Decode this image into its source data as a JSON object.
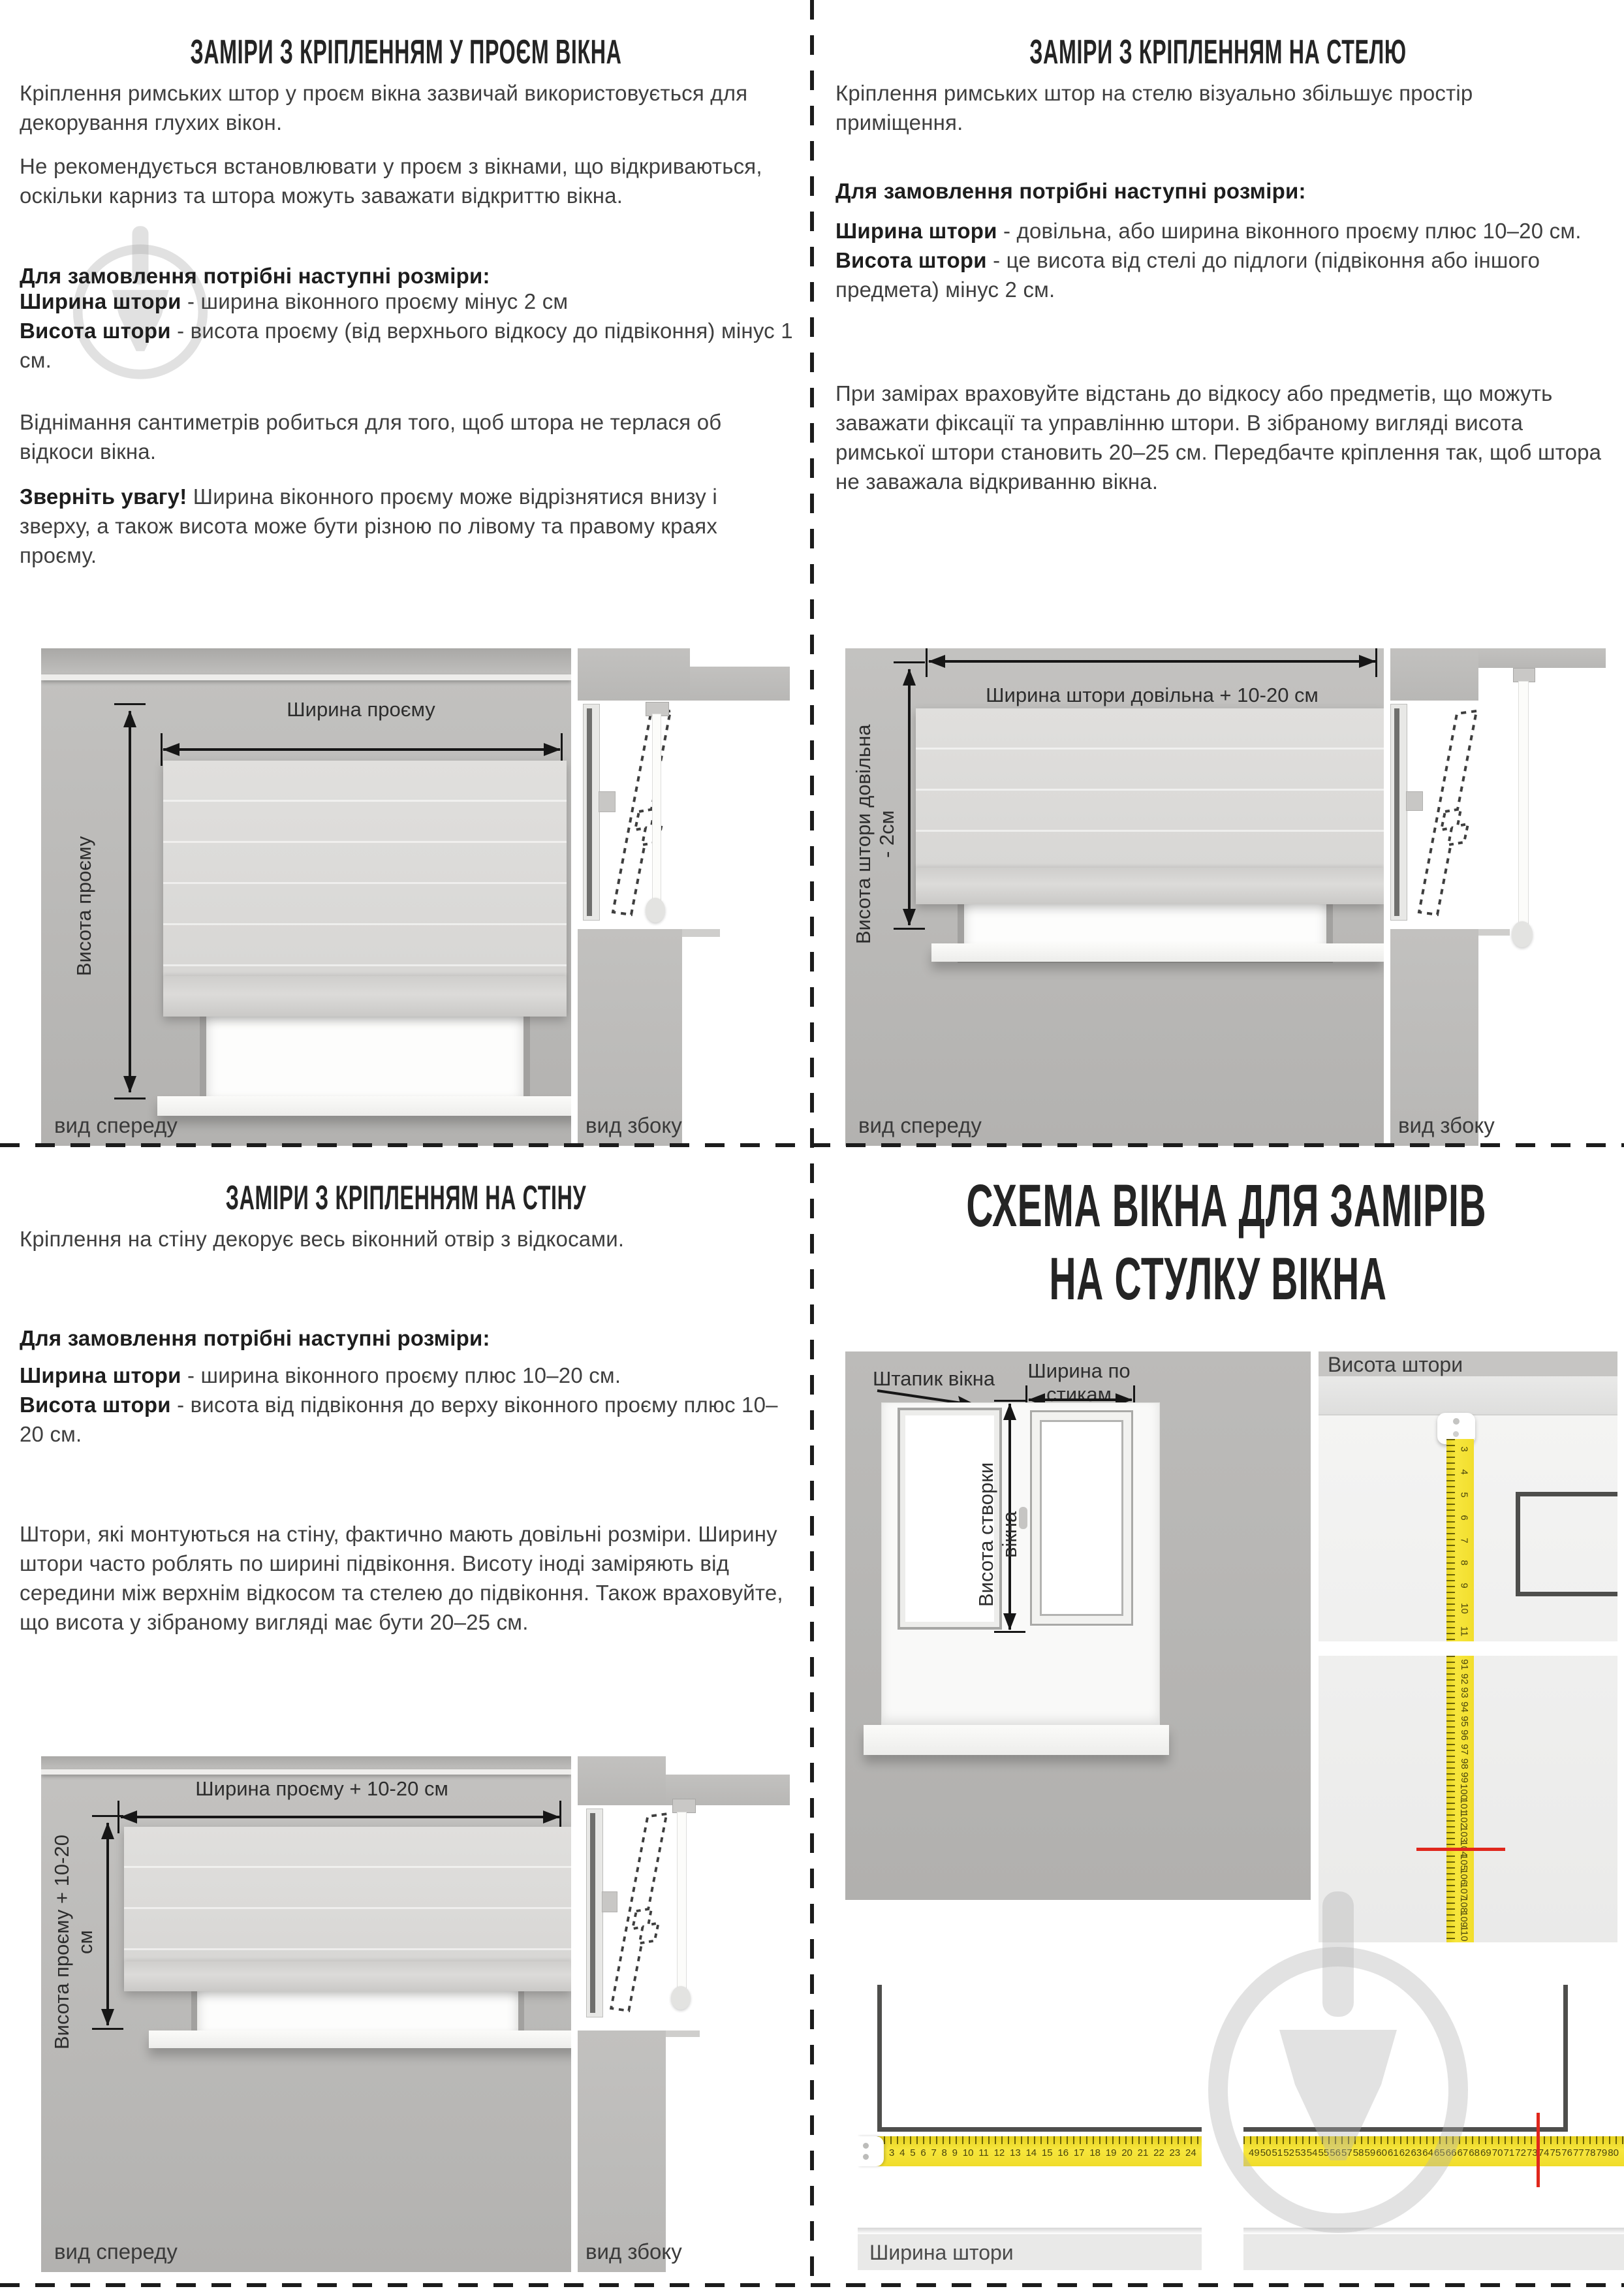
{
  "q1": {
    "title": "ЗАМІРИ З КРІПЛЕННЯМ У ПРОЄМ ВІКНА",
    "p1": "Кріплення римських штор у проєм вікна зазвичай використовується для декорування глухих вікон.",
    "p2": "Не рекомендується встановлювати у проєм з вікнами, що відкриваються, оскільки карниз та штора можуть заважати відкриттю вікна.",
    "lead": "Для замовлення потрібні наступні розміри:",
    "width_term": "Ширина штори",
    "width_def": " - ширина віконного проєму мінус 2 см",
    "height_term": "Висота штори",
    "height_def": " - висота проєму (від верхнього відкосу до підвіконня) мінус 1 см.",
    "p3": "Віднімання сантиметрів робиться для того, щоб штора не терлася об відкоси вікна.",
    "note_term": "Зверніть увагу!",
    "note_def": " Ширина віконного проєму може відрізнятися внизу і зверху, а також висота може бути різною по лівому та правому краях проєму.",
    "diagram": {
      "width_label": "Ширина проєму",
      "height_label": "Висота проєму",
      "front_view": "вид спереду",
      "side_view": "вид збоку"
    }
  },
  "q2": {
    "title": "ЗАМІРИ З КРІПЛЕННЯМ НА СТЕЛЮ",
    "p1": "Кріплення римських штор на стелю візуально збільшує простір приміщення.",
    "lead": "Для замовлення потрібні наступні розміри:",
    "width_term": "Ширина штори",
    "width_def": " - довільна, або ширина віконного проєму плюс 10–20 см.",
    "height_term": "Висота штори",
    "height_def": " - це висота від стелі до підлоги (підвіконня або іншого предмета) мінус 2 см.",
    "p2": "При замірах враховуйте відстань до відкосу або предметів, що можуть заважати фіксації та управлінню штори. В зібраному вигляді висота римської штори становить 20–25 см. Передбачте кріплення так, щоб штора не заважала відкриванню вікна.",
    "diagram": {
      "width_label": "Ширина штори довільна + 10-20 см",
      "height_label": "Висота штори довільна - 2см",
      "front_view": "вид спереду",
      "side_view": "вид збоку"
    }
  },
  "q3": {
    "title": "ЗАМІРИ З КРІПЛЕННЯМ НА СТІНУ",
    "p1": "Кріплення на стіну декорує весь віконний отвір з відкосами.",
    "lead": "Для замовлення потрібні наступні розміри:",
    "width_term": "Ширина штори",
    "width_def": " - ширина віконного проєму плюс 10–20 см.",
    "height_term": "Висота штори",
    "height_def": " - висота від підвіконня до верху віконного проєму плюс 10–20 см.",
    "p2": "Штори, які монтуються на стіну, фактично мають довільні розміри. Ширину штори часто роблять по ширині підвіконня. Висоту іноді заміряють від середини між верхнім відкосом та стелею до підвіконня. Також враховуйте, що висота у зібраному вигляді має бути 20–25 см.",
    "diagram": {
      "width_label": "Ширина проєму + 10-20 см",
      "height_label": "Висота проєму + 10-20 см",
      "front_view": "вид спереду",
      "side_view": "вид збоку"
    }
  },
  "q4": {
    "title_line1": "СХЕМА ВІКНА ДЛЯ ЗАМІРІВ",
    "title_line2": "НА СТУЛКУ ВІКНА",
    "labels": {
      "bead": "Штапик вікна",
      "bead_width": "Ширина по стикам штапика",
      "sash_height": "Висота створки вікна",
      "curtain_height": "Висота штори",
      "curtain_width": "Ширина штори"
    },
    "tape": {
      "vertical_upper": [
        "3",
        "4",
        "5",
        "6",
        "7",
        "8",
        "9",
        "10",
        "11"
      ],
      "vertical_lower": [
        "91",
        "92",
        "93",
        "94",
        "95",
        "96",
        "97",
        "98",
        "99",
        "100",
        "101",
        "102",
        "103",
        "104",
        "105",
        "106",
        "107",
        "108",
        "109",
        "110"
      ],
      "horizontal_left": [
        "3",
        "4",
        "5",
        "6",
        "7",
        "8",
        "9",
        "10",
        "11",
        "12",
        "13",
        "14",
        "15",
        "16",
        "17",
        "18",
        "19",
        "20",
        "21",
        "22",
        "23",
        "24"
      ],
      "horizontal_right": [
        "49",
        "50",
        "51",
        "52",
        "53",
        "54",
        "55",
        "56",
        "57",
        "58",
        "59",
        "60",
        "61",
        "62",
        "63",
        "64",
        "65",
        "66",
        "67",
        "68",
        "69",
        "70",
        "71",
        "72",
        "73",
        "74",
        "75",
        "76",
        "77",
        "78",
        "79",
        "80"
      ],
      "red_mark_height_cm": "104",
      "red_mark_width_cm": "73"
    }
  }
}
